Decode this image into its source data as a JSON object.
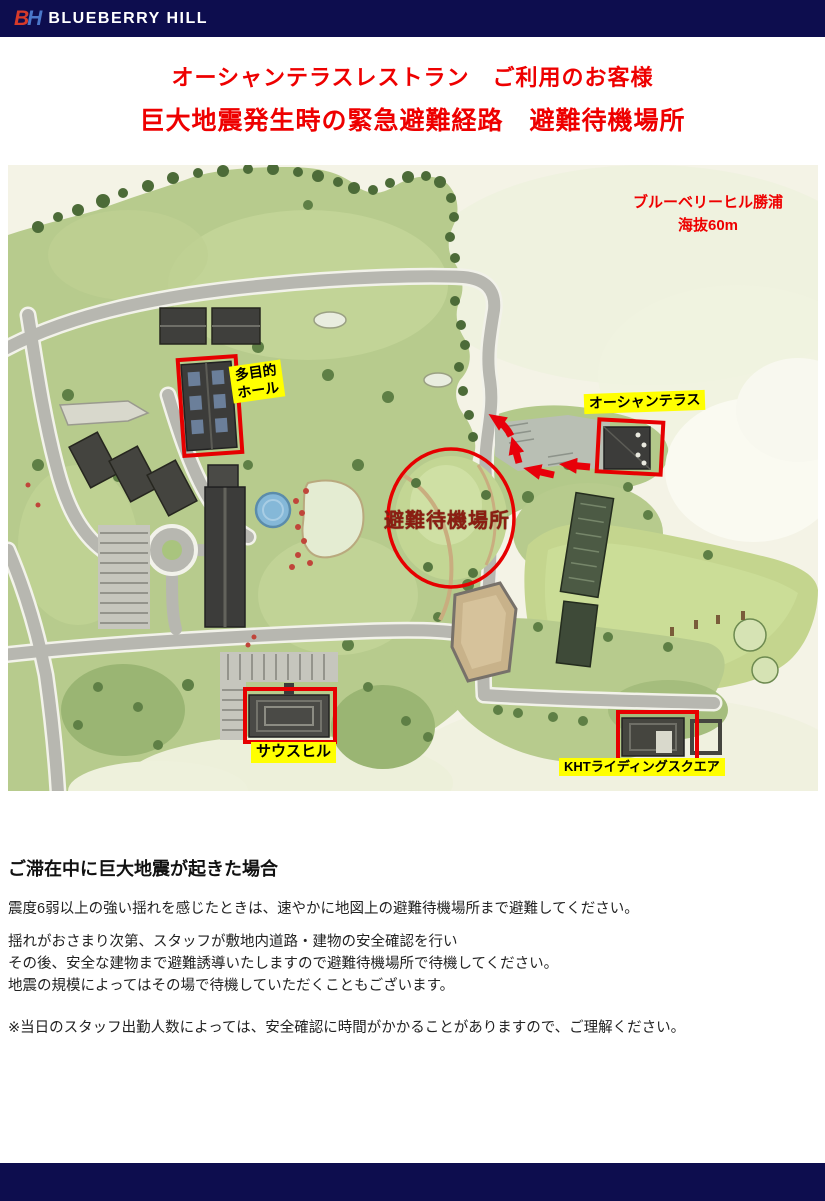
{
  "header": {
    "logo_b": "B",
    "logo_h": "H",
    "brand": "BLUEBERRY HILL"
  },
  "titles": {
    "line1": "オーシャンテラスレストラン　ご利用のお客様",
    "line2": "巨大地震発生時の緊急避難経路　避難待機場所"
  },
  "map": {
    "site_label_line1": "ブルーベリーヒル勝浦",
    "site_label_line2": "海抜60m",
    "labels": {
      "hall_line1": "多目的",
      "hall_line2": "ホール",
      "ocean_terrace": "オーシャンテラス",
      "waiting_area": "避難待機場所",
      "south_hill": "サウスヒル",
      "kht": "KHTライディングスクエア"
    }
  },
  "body": {
    "heading": "ご滞在中に巨大地震が起きた場合",
    "p1": "震度6弱以上の強い揺れを感じたときは、速やかに地図上の避難待機場所まで避難してください。",
    "p2_line1": "揺れがおさまり次第、スタッフが敷地内道路・建物の安全確認を行い",
    "p2_line2": "その後、安全な建物まで避難誘導いたしますので避難待機場所で待機してください。",
    "p2_line3": "地震の規模によってはその場で待機していただくこともございます。",
    "note": "※当日のスタッフ出勤人数によっては、安全確認に時間がかかることがありますので、ご理解ください。"
  },
  "colors": {
    "header_navy": "#0d0d4e",
    "title_red": "#ee0000",
    "annotation_red": "#e60000",
    "label_yellow": "#ffff00",
    "waiting_text_red": "#8b1e12"
  }
}
